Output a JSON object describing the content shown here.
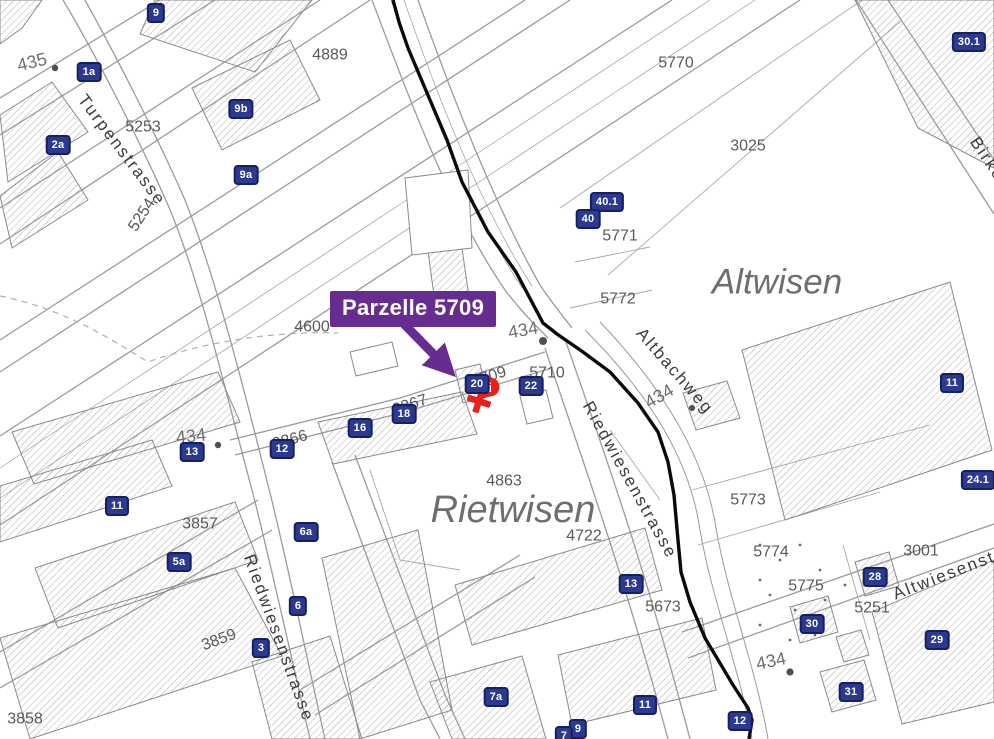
{
  "callout": {
    "text": "Parzelle 5709"
  },
  "marker": {
    "glyph": "i"
  },
  "area_labels": {
    "altwisen": "Altwisen",
    "rietwisen": "Rietwisen"
  },
  "streets": {
    "turpenstrasse": "Turpenstrasse",
    "riedwiesenstrasse_left": "Riedwiesenstrasse",
    "riedwiesenstrasse_right": "Riedwiesenstrasse",
    "altbachweg": "Altbachweg",
    "birkenstrasse": "Birkenstrasse",
    "altwiesenstrasse": "Altwiesenstrasse"
  },
  "contours": [
    "435",
    "434",
    "434",
    "434",
    "434"
  ],
  "parcels": [
    "4889",
    "5253",
    "5254",
    "5770",
    "3025",
    "5771",
    "5772",
    "4600",
    "5709",
    "5710",
    "2867",
    "2866",
    "3857",
    "4863",
    "4722",
    "5673",
    "3859",
    "3858",
    "5773",
    "5774",
    "5775",
    "5251",
    "3001"
  ],
  "badges": [
    "9",
    "1a",
    "2a",
    "9b",
    "9a",
    "40.1",
    "40",
    "30.1",
    "11",
    "24.1",
    "20",
    "22",
    "18",
    "16",
    "12",
    "13",
    "11",
    "6a",
    "5a",
    "6",
    "3",
    "13",
    "7a",
    "11",
    "9",
    "7",
    "12",
    "28",
    "30",
    "29",
    "31"
  ],
  "colors": {
    "badge_bg": "#2B3990",
    "badge_border": "#16205E",
    "callout_bg": "#672C90",
    "marker_red": "#E8211D",
    "boundary": "#000000",
    "building_hatch": "#9A9A9A",
    "road_line": "#9B9B9B",
    "parcel_text": "#595959",
    "area_text": "#6E6E6E"
  }
}
